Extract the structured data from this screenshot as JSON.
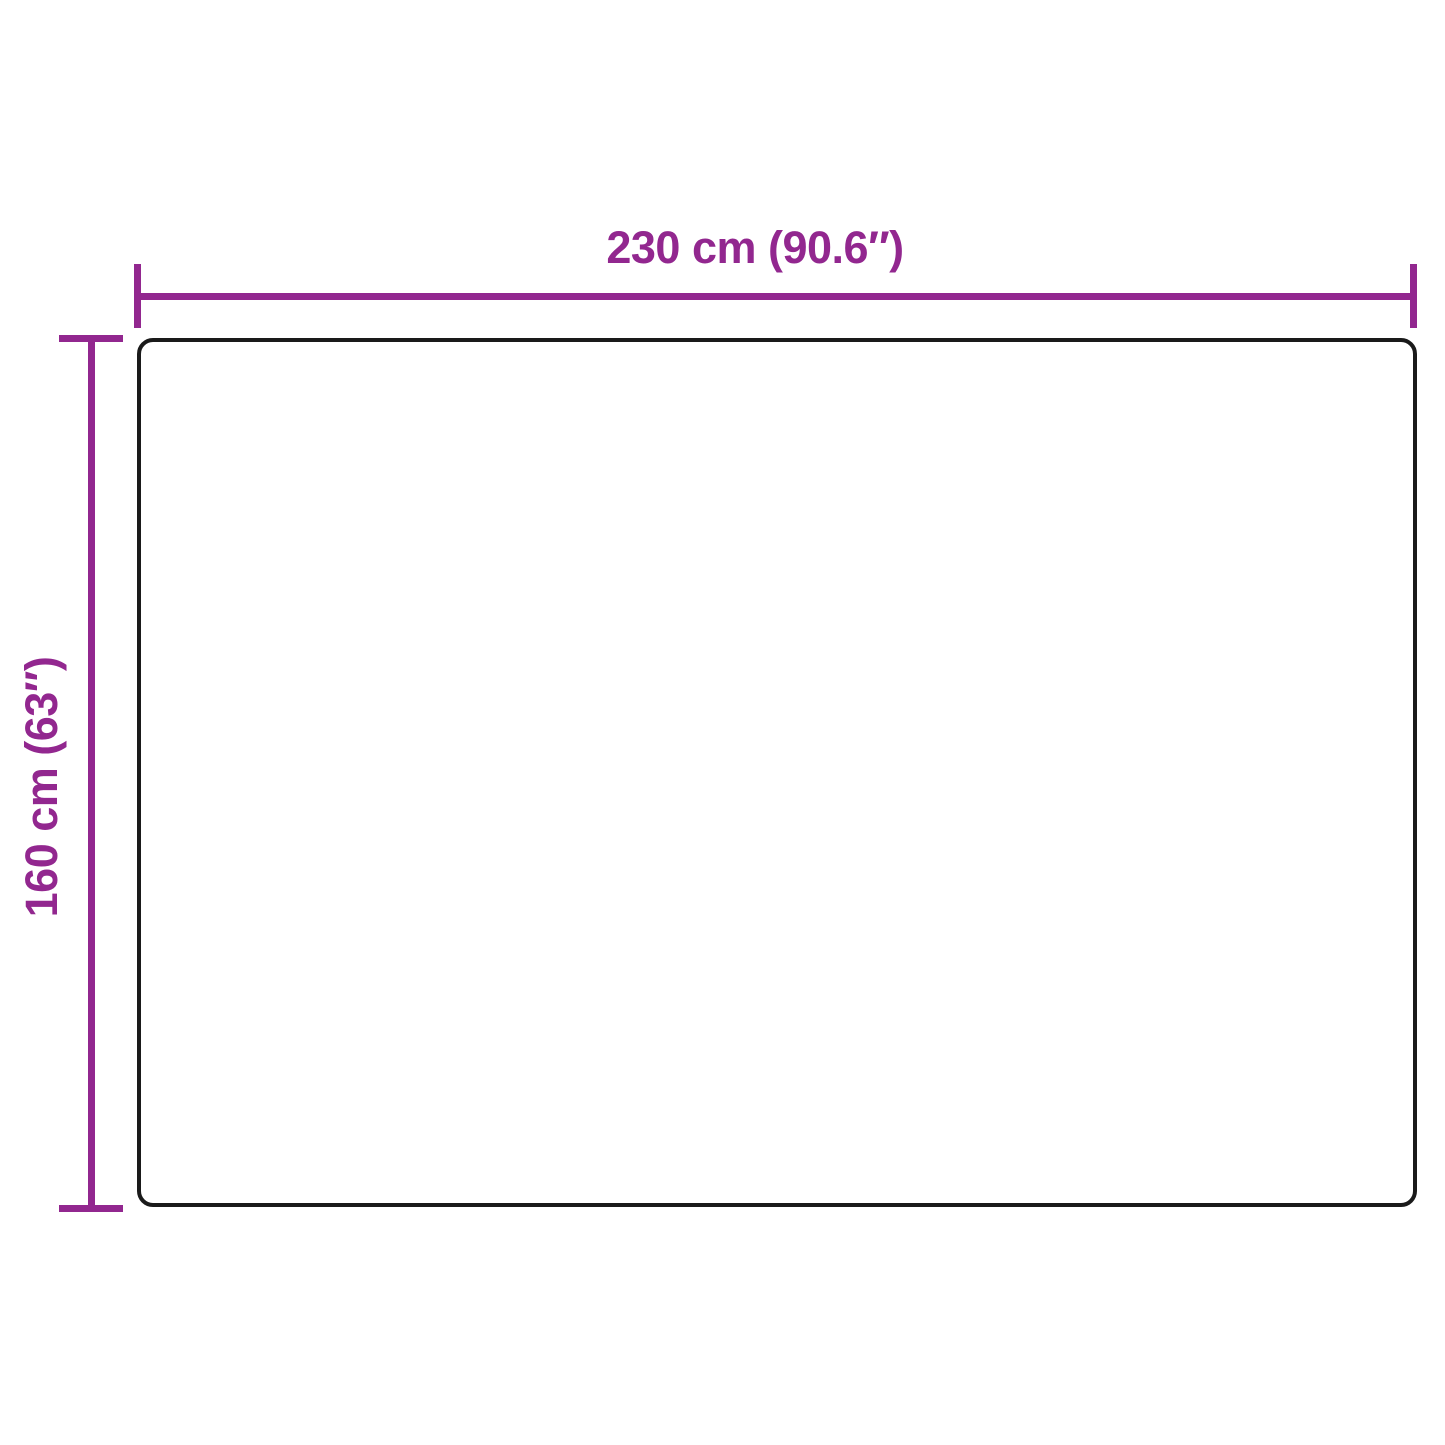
{
  "diagram": {
    "type": "product-dimension-diagram",
    "width_label": "230 cm (90.6″)",
    "height_label": "160 cm (63″)",
    "width_value_cm": 230,
    "width_value_in": 90.6,
    "height_value_cm": 160,
    "height_value_in": 63
  },
  "colors": {
    "accent": "#92278F",
    "outline": "#1a1a1a",
    "bg": "#ffffff"
  }
}
